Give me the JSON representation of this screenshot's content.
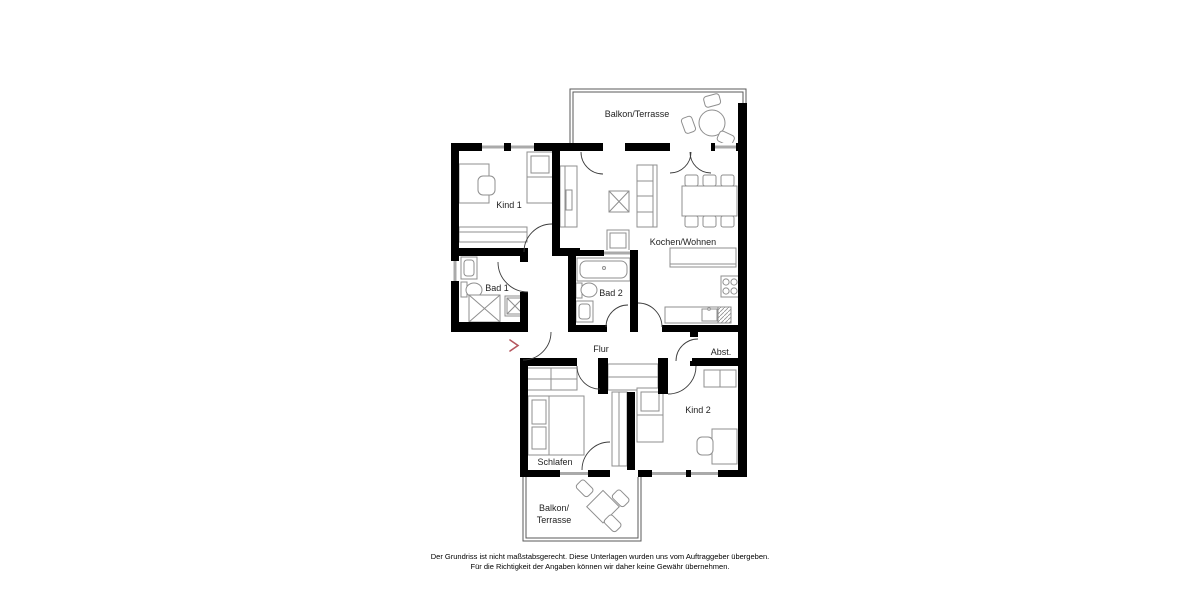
{
  "floorplan": {
    "rooms": [
      {
        "id": "balkon-terrasse-top",
        "label": "Balkon/Terrasse"
      },
      {
        "id": "kind-1",
        "label": "Kind 1"
      },
      {
        "id": "kochen-wohnen",
        "label": "Kochen/Wohnen"
      },
      {
        "id": "bad-1",
        "label": "Bad 1"
      },
      {
        "id": "bad-2",
        "label": "Bad 2"
      },
      {
        "id": "flur",
        "label": "Flur"
      },
      {
        "id": "abstellraum",
        "label": "Abst."
      },
      {
        "id": "schlafen",
        "label": "Schlafen"
      },
      {
        "id": "kind-2",
        "label": "Kind 2"
      },
      {
        "id": "balkon-terrasse-bottom",
        "label_line1": "Balkon/",
        "label_line2": "Terrasse"
      }
    ],
    "entrance": {
      "marker": "chevron-right",
      "color": "#b5565e"
    },
    "colors": {
      "wall": "#000000",
      "furniture_outline": "#8f8f8f",
      "door_swing": "#3c3c3c",
      "window_glazing": "#aaaaaa",
      "balcony_outline": "#5a5a5a",
      "label_text": "#1f1f1f"
    }
  },
  "disclaimer": {
    "line1": "Der Grundriss ist nicht maßstabsgerecht. Diese Unterlagen wurden uns vom Auftraggeber übergeben.",
    "line2": "Für die Richtigkeit der Angaben können wir daher keine Gewähr übernehmen."
  }
}
